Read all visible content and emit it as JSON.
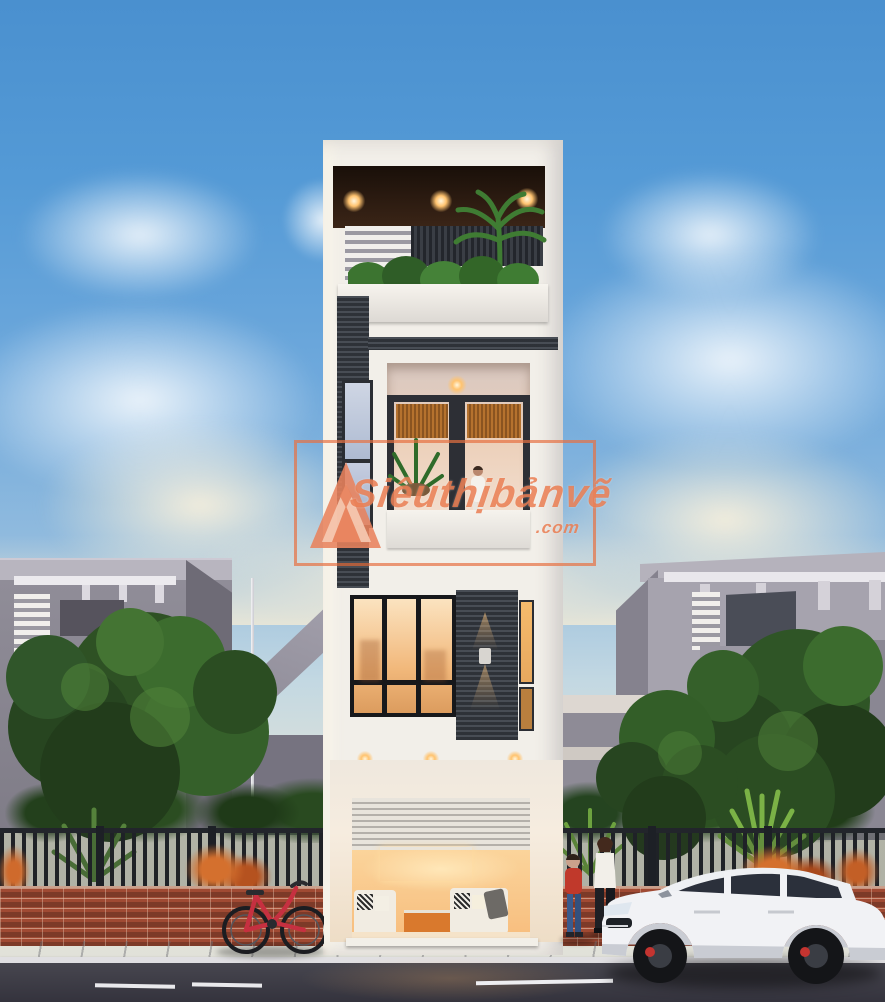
{
  "watermark": {
    "brand": "Siêuthịbảnvẽ",
    "tld": ".com",
    "logo": "triangle-mountain-logo",
    "accent_color": "#e8764a"
  },
  "scene_objects": [
    "modern-townhouse-elevation",
    "rooftop-terrace-with-lights-and-plants",
    "third-floor-balcony-with-person",
    "second-floor-black-frame-window",
    "ground-floor-living-room-with-roller-shutter",
    "neighbor-house-left",
    "neighbor-house-right",
    "iron-fence-and-brick-wall",
    "red-bicycle",
    "white-suv-car",
    "woman-pedestrian",
    "child-pedestrian",
    "street-and-sidewalk",
    "evening-sky-with-clouds"
  ],
  "palette": {
    "sky_top": "#4a90cf",
    "sky_horizon": "#e7e5d6",
    "tower_white": "#f2efe9",
    "slate_dark": "#3d424a",
    "warm_light": "#ffc36f",
    "wood_ceiling": "#33221a",
    "brick_red": "#a04a33",
    "foliage_green": "#335c28",
    "shrub_orange": "#cf6a2c",
    "road_asphalt": "#3c3c46",
    "car_body": "#f1f2f5",
    "brake_caliper": "#c43430",
    "bicycle_red": "#c63040",
    "watermark_orange": "#e8764a"
  }
}
